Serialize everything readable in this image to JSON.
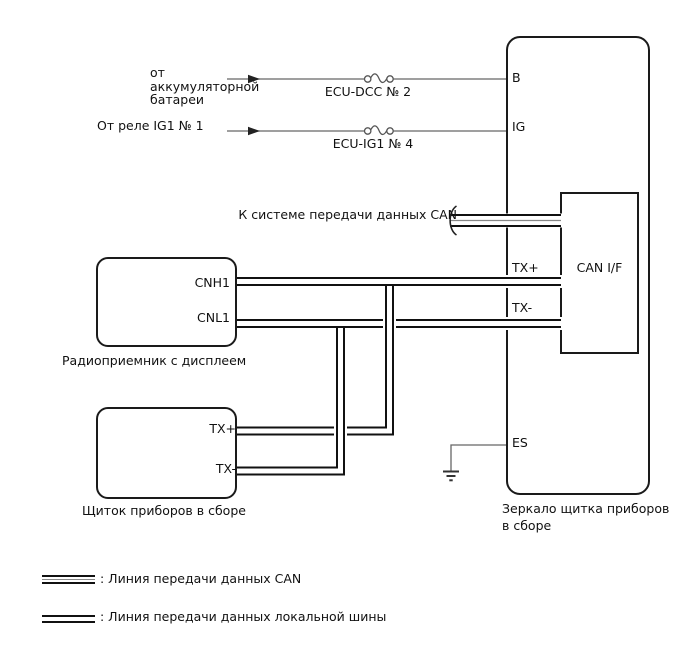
{
  "colors": {
    "bus_line": "#111111",
    "thin_wire": "#666666",
    "background": "#ffffff"
  },
  "sources": {
    "battery_line1": "от",
    "battery_line2": "аккумуляторной",
    "battery_line3": "батареи",
    "fuse_b": "ECU-DCC № 2",
    "relay": "От реле IG1 № 1",
    "fuse_ig": "ECU-IG1 № 4"
  },
  "can_stub_label": "К системе передачи данных CAN",
  "radio": {
    "caption": "Радиоприемник с дисплеем",
    "terminal_cnh1": "CNH1",
    "terminal_cnl1": "CNL1"
  },
  "instrument": {
    "caption": "Щиток приборов в сборе",
    "terminal_txp": "TX+",
    "terminal_txm": "TX-"
  },
  "mirror": {
    "caption_line1": "Зеркало щитка приборов",
    "caption_line2": "в сборе",
    "terminal_b": "B",
    "terminal_ig": "IG",
    "terminal_txp": "TX+",
    "terminal_txm": "TX-",
    "terminal_es": "ES",
    "can_if_label": "CAN I/F"
  },
  "legend": {
    "can_label": ": Линия передачи данных CAN",
    "local_label": ": Линия передачи данных локальной шины"
  }
}
